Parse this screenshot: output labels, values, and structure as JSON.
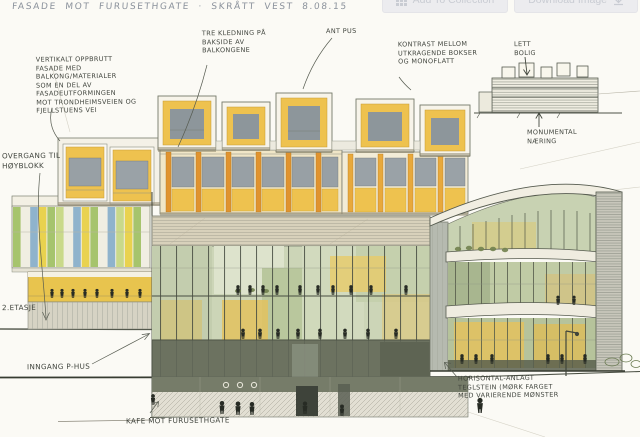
{
  "toolbar": {
    "add_to_collection_label": "Add To Collection",
    "download_image_label": "Download Image"
  },
  "sketch": {
    "title": "FASADE MOT FURUSETHGATE · SKRÅTT VEST  8.08.15",
    "annotations": {
      "facade_note": "VERTIKALT OPPBRUTT\nFASADE MED\nBALKONG/MATERIALER\nSOM EN DEL AV FASADEUTFORMINGEN\nMOT TRONDHEIMSVEIEN OG\nFJELLSTUENS VEI",
      "wood_cladding": "TRE KLEDNING PÅ\nBAKSIDE AV\nBALKONGENE",
      "plaster": "ANT PUS",
      "contrast": "KONTRAST MELLOM\nUTKRAGENDE BOKSER\nOG MONOFLATT",
      "inset_light_housing": "LETT\nBOLIG",
      "inset_monumental": "MONUMENTAL\nNÆRING",
      "transition": "OVERGANG TIL\nHØYBLOKK",
      "second_floor": "2.ETASJE",
      "parking_entrance": "INNGANG P-HUS",
      "cafe": "KAFE MOT FURUSETHGATE",
      "brick": "HORISONTAL-ANLAGT\nTEGLSTEIN (MØRK FARGET\nMED VARIERENDE MØNSTER"
    },
    "colors": {
      "paper": "#fbfaf5",
      "pencil": "#565b50",
      "balcony_yellow": "#eec24f",
      "accent_orange": "#e0932f",
      "glass_green": "#ccd5b7",
      "interior_glow": "#e2c25f",
      "window_gray": "#98a0a5",
      "base_dark_olive": "#6c7260",
      "figure_dark": "#272b24",
      "panel_blue": "#8fb3cc",
      "panel_green": "#a6c46d"
    }
  }
}
